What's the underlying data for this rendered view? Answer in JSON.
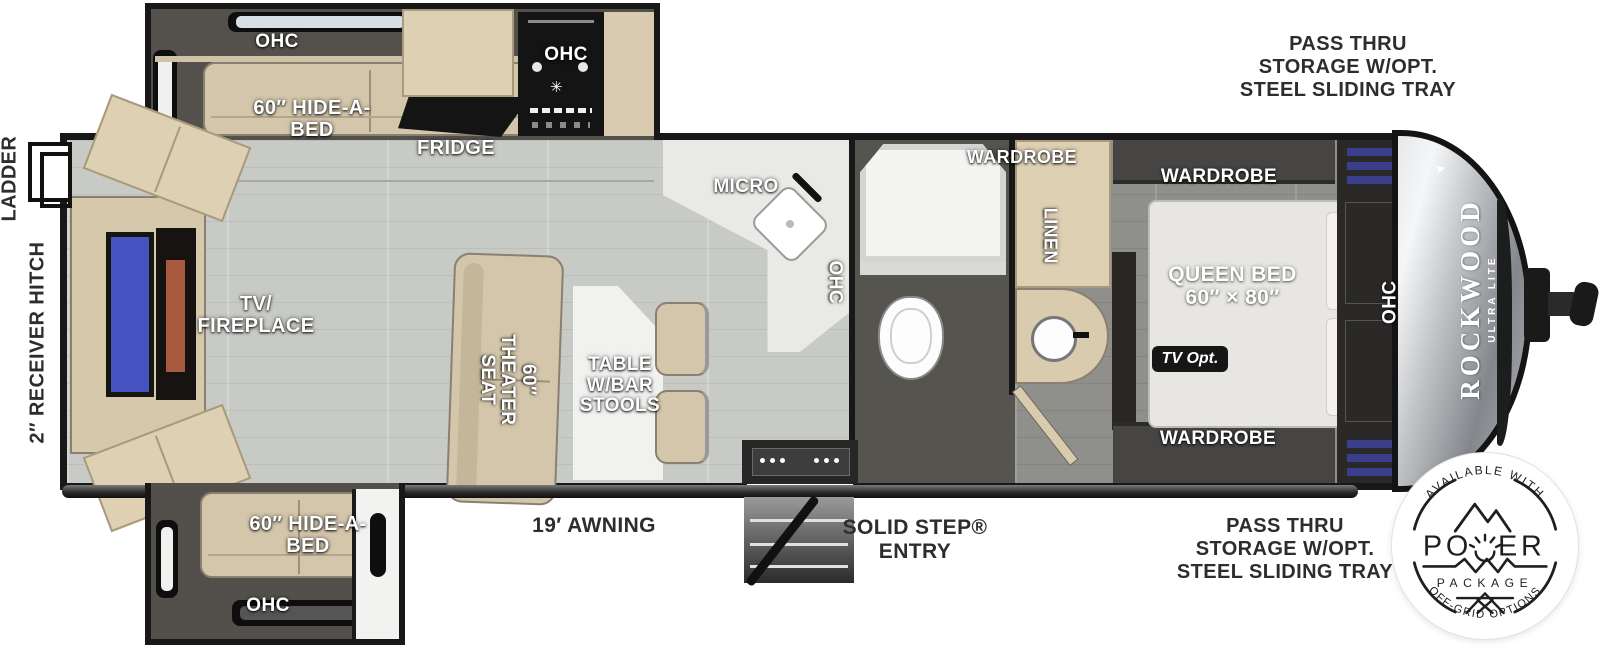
{
  "title": "Rockwood Ultra Lite travel trailer floorplan",
  "colors": {
    "wall": "#181818",
    "floor_main": "#c8cac5",
    "floor_bedroom": "#8f8f8c",
    "floor_bath": "#56544f",
    "furniture_tan": "#d3c6ab",
    "cabinet_tan": "#ddd0b3",
    "counter_white": "#e9e9e6",
    "appliance_black": "#141414",
    "tv_screen_blue": "#4853c2",
    "fireplace_orange": "#a85a3e",
    "front_cap_gray": "#9aa0a4",
    "label_white": "#ffffff",
    "label_dark": "#2d2d2d",
    "badge_ink": "#1f1f1f"
  },
  "exterior": {
    "pass_thru_top": "PASS THRU\nSTORAGE W/OPT.\nSTEEL SLIDING TRAY",
    "pass_thru_bottom": "PASS THRU\nSTORAGE W/OPT.\nSTEEL SLIDING TRAY",
    "ladder": "LADDER",
    "receiver_hitch": "2″ RECEIVER HITCH",
    "awning": "19′ AWNING",
    "entry": "SOLID STEP®\nENTRY"
  },
  "front_slide": {
    "ohc": "OHC",
    "hide_a_bed": "60″ HIDE-A-\nBED",
    "fridge": "FRIDGE",
    "ohc_stove": "OHC"
  },
  "kitchen": {
    "micro": "MICRO",
    "ohc": "OHC"
  },
  "living": {
    "tv_fireplace": "TV/\nFIREPLACE",
    "theater_seat": "60″ THEATER\nSEAT",
    "table": "TABLE\nW/BAR\nSTOOLS"
  },
  "rear_slide": {
    "hide_a_bed": "60″ HIDE-A-\nBED",
    "ohc": "OHC"
  },
  "bedroom": {
    "wardrobe_bath": "WARDROBE",
    "linen": "LINEN",
    "wardrobe_top": "WARDROBE",
    "queen_bed": "QUEEN BED\n60″ × 80″",
    "tv_opt": "TV Opt.",
    "wardrobe_bottom": "WARDROBE",
    "ohc": "OHC"
  },
  "brand": {
    "name": "ROCKWOOD",
    "sub": "ULTRA LITE"
  },
  "badge": {
    "arc_top": "AVAILABLE WITH",
    "power_left": "PO",
    "power_right": "ER",
    "package": "PACKAGE",
    "arc_bottom": "OFF-GRID OPTIONS"
  }
}
